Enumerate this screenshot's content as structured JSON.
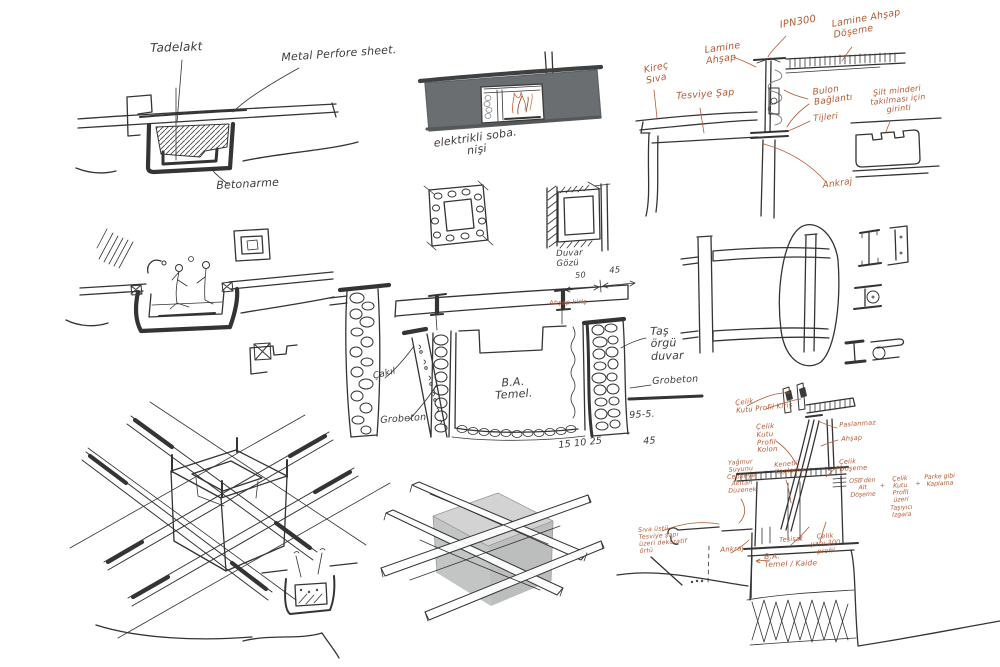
{
  "sheet": {
    "background": "#ffffff",
    "ink": "#343434",
    "accent": "#b55a33",
    "wall_gray": "#6b6e70",
    "cube_gray": "#c6c7c7"
  },
  "labels": {
    "hearth": {
      "tadelakt": "Tadelakt",
      "metal_perfore": "Metal Perfore sheet.",
      "betonarme": "Betonarme"
    },
    "fireplace": {
      "caption": "elektrikli soba.\nnişi"
    },
    "steel_detail": {
      "kirec_siva": "Kireç\nSıva",
      "lamine_ahsap": "Lamine\nAhşap",
      "tesviye_sap": "Tesviye Şap",
      "ipn300": "IPN300",
      "lamine_doseme": "Lamine Ahşap\nDöşeme",
      "bulon": "Bulon\nBağlantı",
      "tijleri": "Tijleri",
      "ankraj": "Ankraj",
      "silt_minderi": "Şilt minderi\ntakılması için\ngirinti"
    },
    "windows": {
      "duvar_gozu": "Duvar\nGözü"
    },
    "foundation": {
      "dim_50": "50",
      "dim_45": "45",
      "ahsap_kiris": "Ahşap kiriş",
      "tas_orgu_duvar": "Taş\nörgü\nduvar",
      "grobeton_sag": "Grobeton",
      "cakil": "Çakıl",
      "grobeton_sol": "Grobeton",
      "ba_temel": "B.A.\nTemel.",
      "olcu_151025": "15 10 25",
      "olcu_95_5": "95-5.",
      "olcu_45": "45"
    },
    "parapet": {
      "kutu_kiris": "Çelik\nKutu Profil Kiriş",
      "kutu_kolon": "Çelik\nKutu\nProfil\nKolon",
      "paslanmaz": "Paslanmaz",
      "ahsap": "Ahşap",
      "celik_doseme": "Çelik\nDöşeme",
      "osb": "OSB'den\nAlt\nDöşeme",
      "plus": "+",
      "kutu_tasiyici": "Çelik\nKutu\nProfil\nüzeri\nTaşıyıcı\nIzgara",
      "parke": "Parke gibi\nKaplama",
      "yagmur": "Yağmur\nSuyunu\nCepheye\nAkıtan\nDüzenek",
      "kenetli": "Kenetli\nKaplama",
      "siva_ustu": "Sıva üstü\nTesviye şapı\nüzeri dekoratif\nörtü",
      "ankraj": "Ankraj",
      "tesisat": "Tesisat",
      "celik_profil": "Çelik\nyapı 300\nprofil",
      "ba_kaide": "B.A.\nTemel / Kaide"
    }
  }
}
